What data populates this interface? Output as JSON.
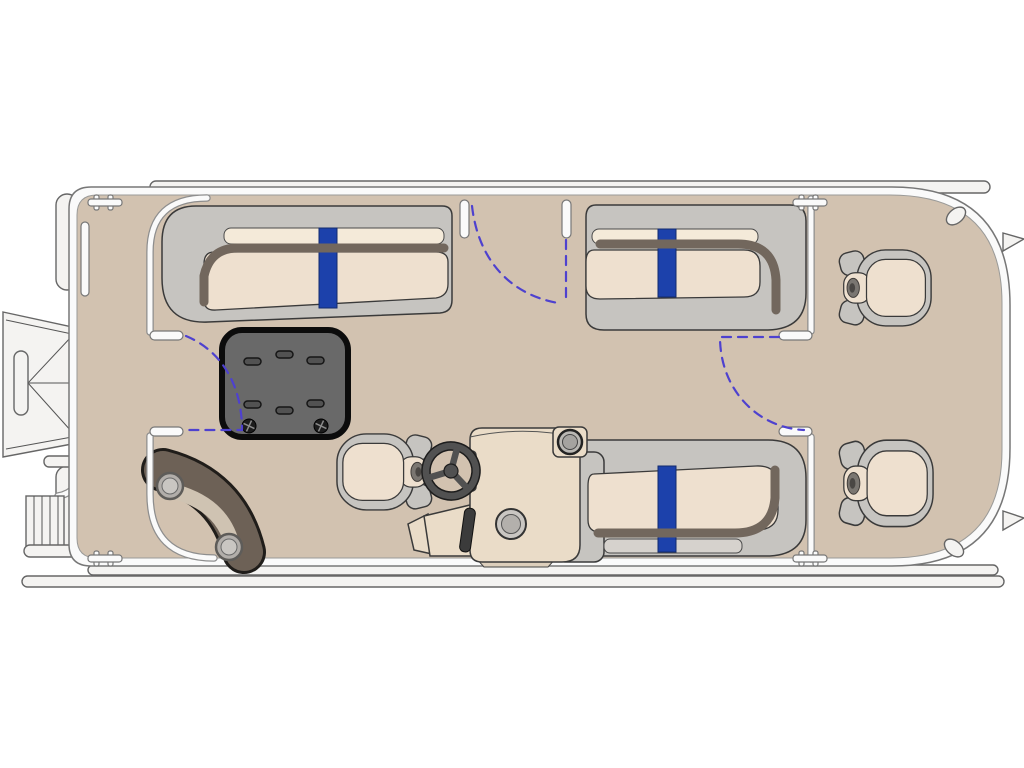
{
  "scene": {
    "type": "boat-floorplan",
    "subject": "pontoon boat deck plan, top view, bow to the right",
    "colors": {
      "background": "#ffffff",
      "deck": "#d2c2b0",
      "rubrail": "#fafafa",
      "white_part": "#f4f3f1",
      "seat_gray": "#c6c4c0",
      "cushion": "#eee0cf",
      "cushion_light": "#f4ead9",
      "rail_brown": "#72675d",
      "accent_blue": "#1c41ab",
      "table_gray": "#696969",
      "table_slot": "#525252",
      "table_border": "#0c0c0c",
      "pad_brown": "#6d6156",
      "pad_insert": "#cfc3b2",
      "console": "#eadcc8",
      "wheel_gray": "#515151",
      "swing_arc": "#4e41cf"
    },
    "components": {
      "lounges": [
        {
          "id": "port-stern-lounge",
          "accent_stripe": true
        },
        {
          "id": "port-bow-lounge",
          "accent_stripe": true
        },
        {
          "id": "starboard-bow-lounge",
          "accent_stripe": true
        }
      ],
      "bow_captain_chairs": 2,
      "helm": {
        "captains_chair": true,
        "console": true,
        "steering_wheel": true,
        "gauge": true,
        "cup_holder": true,
        "throttle": true
      },
      "center_table": {
        "vent_slots": 6,
        "fasteners": 2
      },
      "gates": [
        "stern-gate",
        "port-side-gate",
        "bow-cross-gate"
      ],
      "gate_swing_arcs": 3,
      "stern_boarding": {
        "ramp": true,
        "ladder": true,
        "fenders": 2
      },
      "hardware": {
        "hinges": 4,
        "cleats": 2,
        "nav_lights": 2,
        "rubrail_slot": 1
      },
      "corner_step_pad": {
        "cups": 2
      }
    }
  }
}
